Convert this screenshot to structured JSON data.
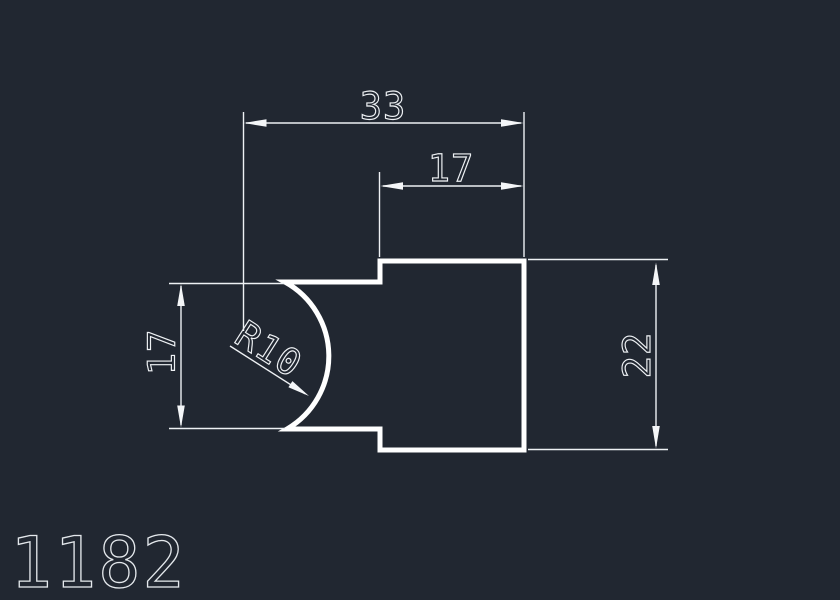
{
  "canvas": {
    "background": "#212731",
    "profile_line_color": "#ffffff",
    "dimension_line_color": "#eef1f4"
  },
  "drawing": {
    "part_number": "1182",
    "dims": {
      "total_width": {
        "label": "33",
        "type": "linear-horizontal"
      },
      "upper_width": {
        "label": "17",
        "type": "linear-horizontal"
      },
      "right_height": {
        "label": "22",
        "type": "linear-vertical"
      },
      "left_height": {
        "label": "17",
        "type": "linear-vertical"
      },
      "radius": {
        "label": "R10",
        "type": "radius-leader"
      }
    }
  }
}
